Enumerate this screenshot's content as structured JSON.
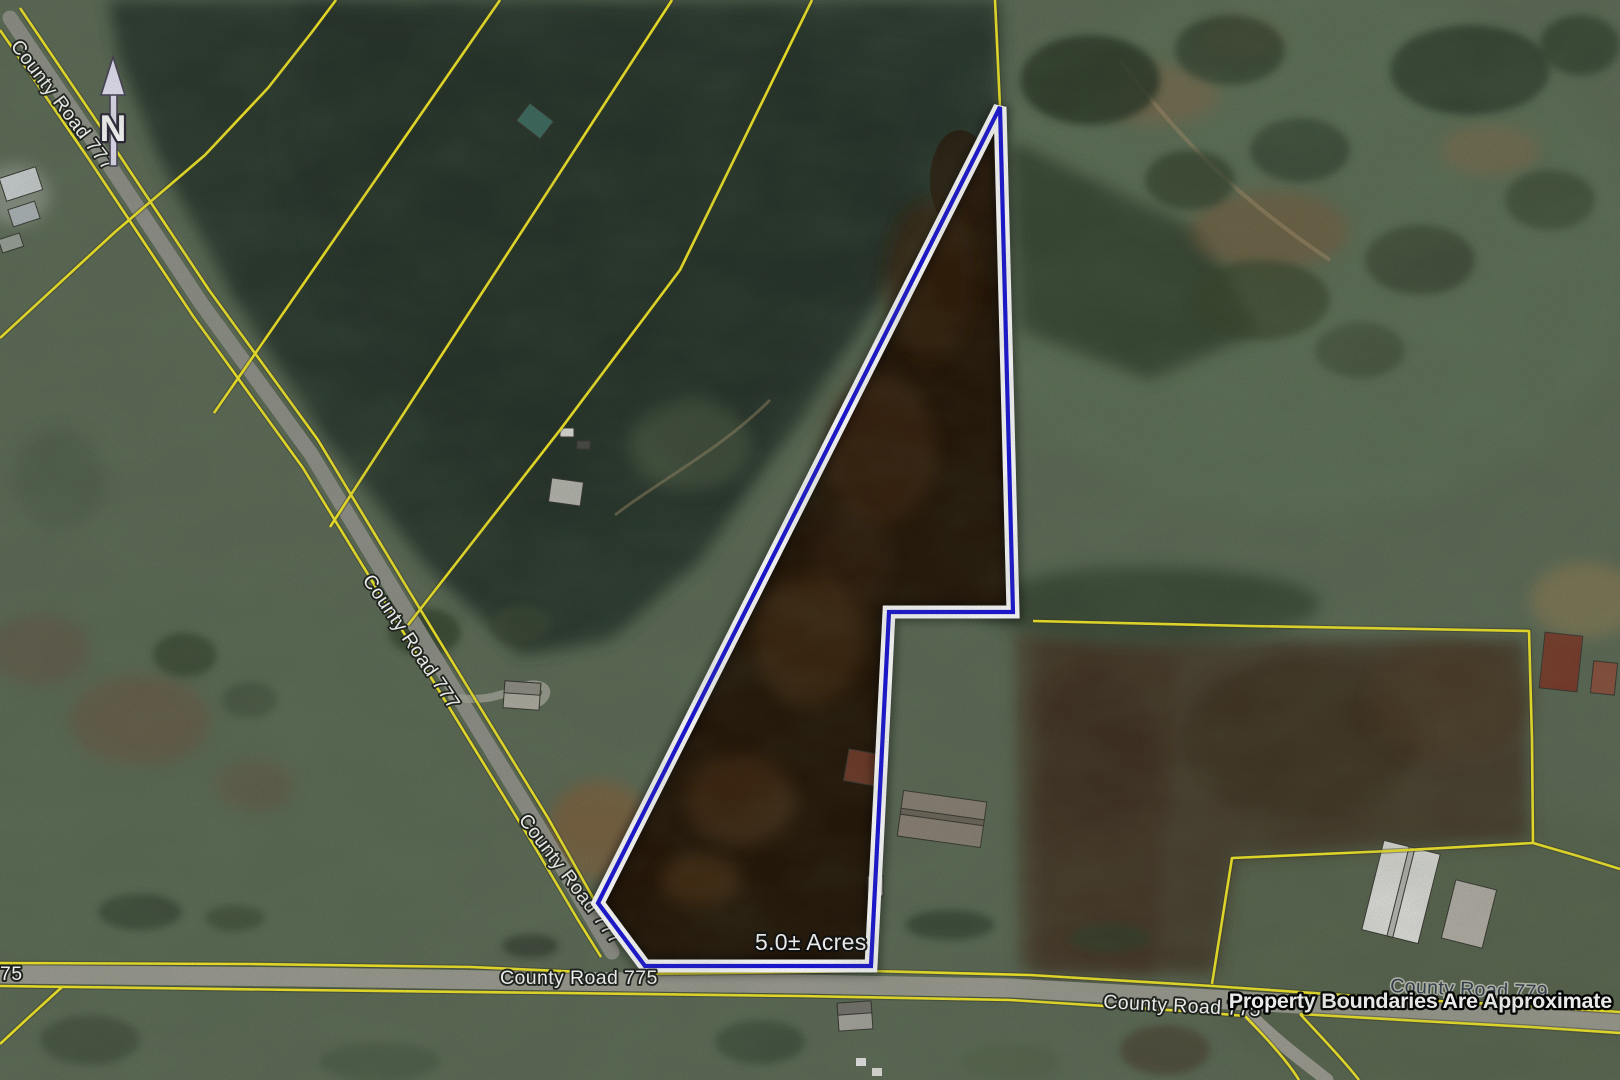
{
  "map": {
    "north_arrow": {
      "label": "N"
    },
    "parcel": {
      "acreage_label": "5.0± Acres"
    },
    "labels": {
      "road_777_upper": "County Road 777",
      "road_777_middle": "County Road 777",
      "road_777_lower": "County Road 777",
      "road_775_left_partial": "75",
      "road_775_center": "County Road 775",
      "road_775_right": "County Road 775",
      "road_775_far_right_faded": "County Road 779",
      "disclaimer": "Property Boundaries Are Approximate"
    },
    "colors": {
      "boundary_line_yellow": "#f2e72c",
      "parcel_outline_blue": "#1d18d8",
      "parcel_casing_white": "#ffffff",
      "label_text": "#ffffff",
      "label_outline": "#1a1a1a",
      "field_green": "#5d6b57",
      "forest_dark": "#2c392d",
      "parcel_interior_brown": "#241608"
    }
  }
}
